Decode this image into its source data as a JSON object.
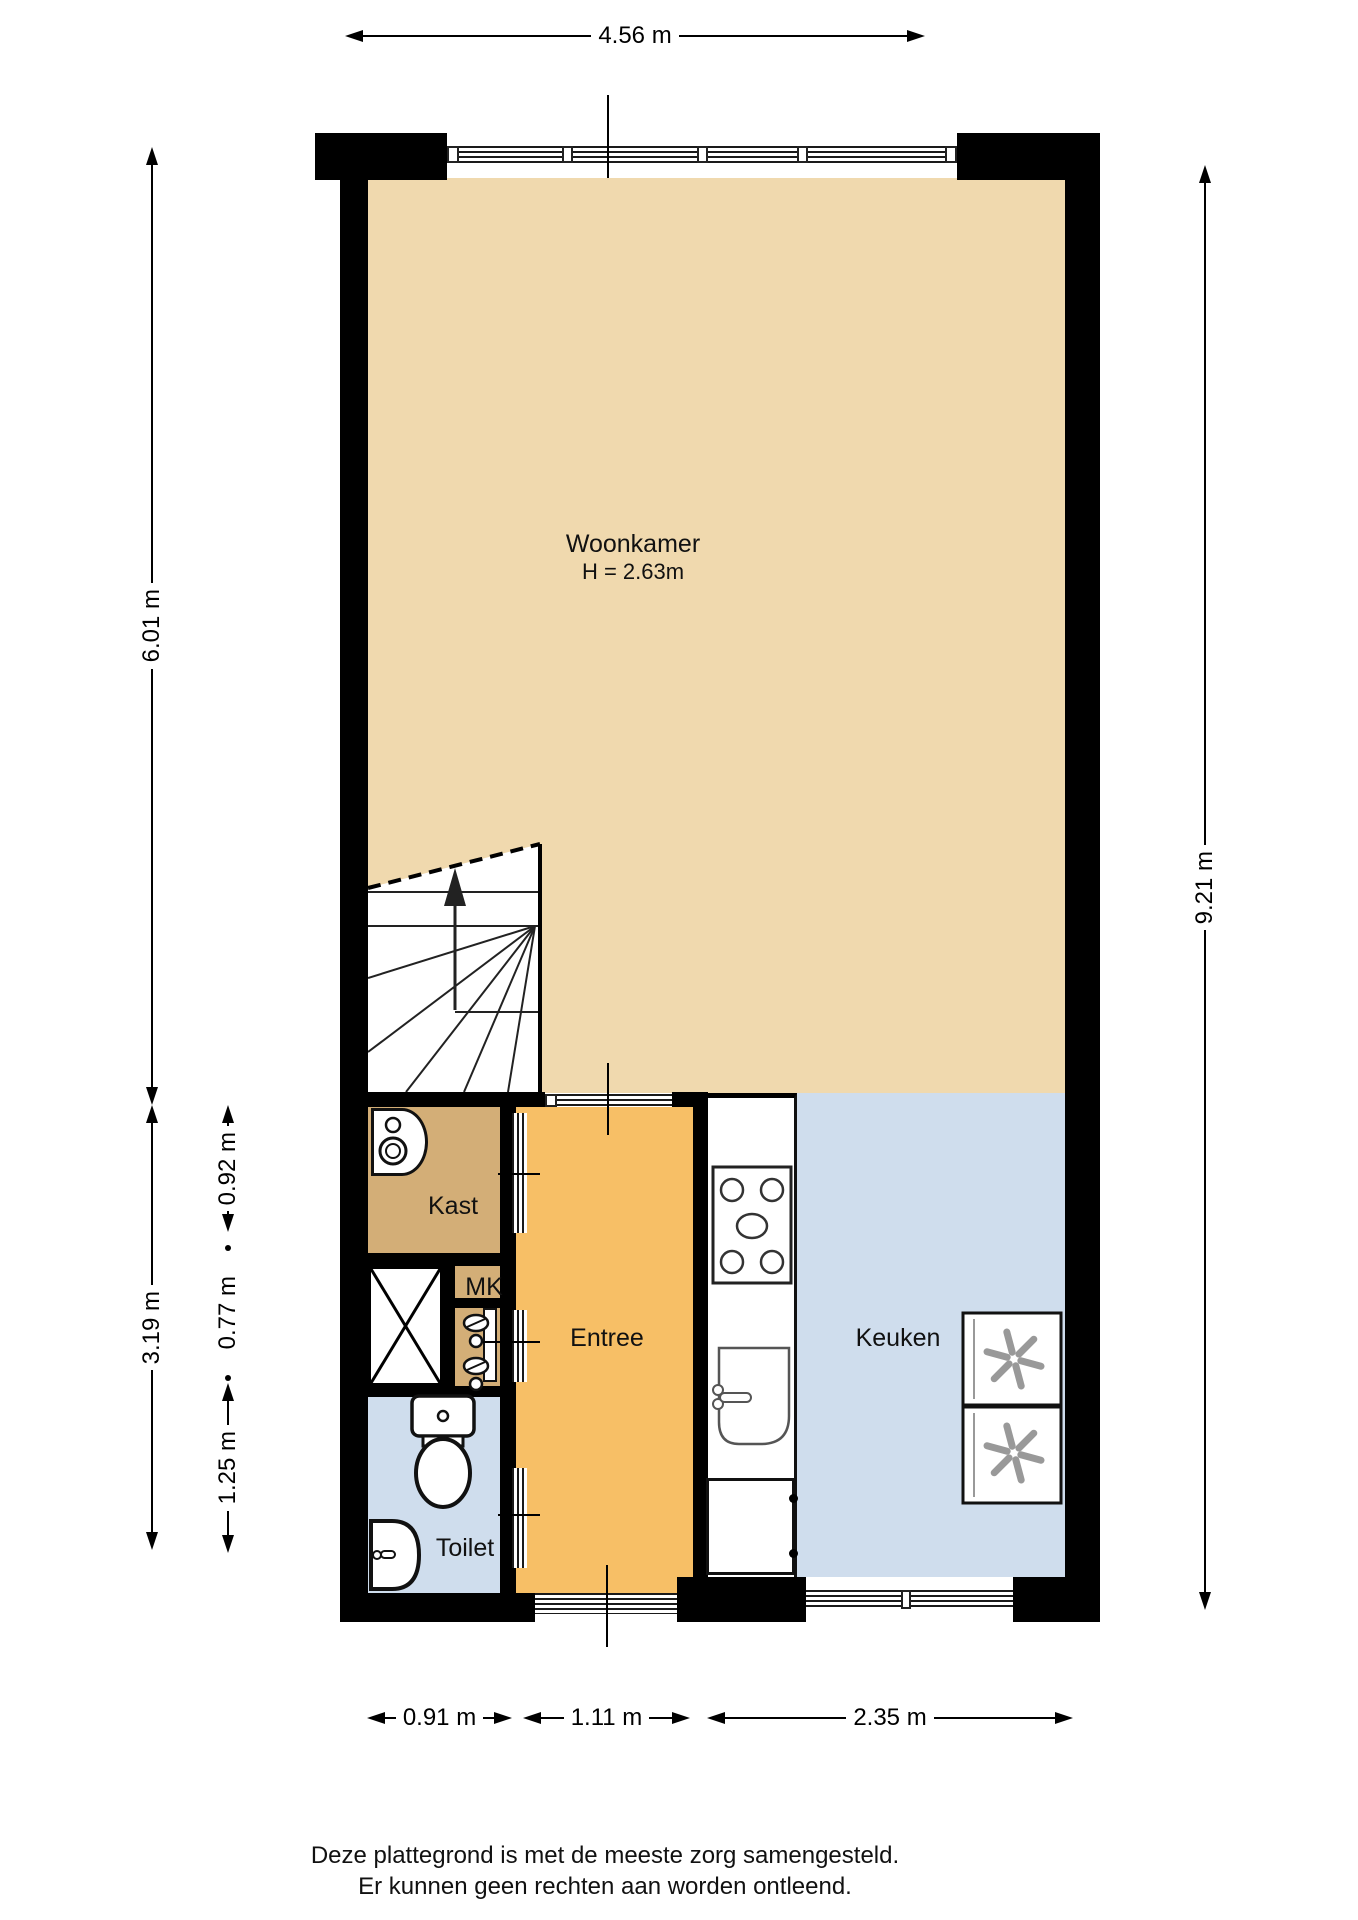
{
  "floorplan": {
    "rooms": {
      "woonkamer": {
        "label": "Woonkamer",
        "ceiling_height": "H = 2.63m"
      },
      "kast": {
        "label": "Kast"
      },
      "mk": {
        "label": "MK"
      },
      "entree": {
        "label": "Entree"
      },
      "toilet": {
        "label": "Toilet"
      },
      "keuken": {
        "label": "Keuken"
      }
    },
    "dimensions": {
      "top_width": "4.56 m",
      "left_upper": "6.01 m",
      "left_lower_total": "3.19 m",
      "left_kast": "0.92 m",
      "left_mk": "0.77 m",
      "left_toilet": "1.25 m",
      "right_height": "9.21 m",
      "bottom_toilet": "0.91 m",
      "bottom_entree": "1.11 m",
      "bottom_keuken": "2.35 m"
    },
    "colors": {
      "living_fill": "#f0d9ae",
      "closet_fill": "#d3ae77",
      "hall_fill": "#f7bf66",
      "wet_room_fill": "#cfdded",
      "wall": "#000000"
    },
    "icons": {
      "stairs": "stairs-up-arrow-icon",
      "washer": "washing-machine-icon",
      "meter": "electric-meter-icon",
      "shaft": "shaft-cross-icon",
      "toilet": "toilet-icon",
      "hand_basin": "hand-basin-icon",
      "stove": "stove-4-burner-icon",
      "sink": "kitchen-sink-icon",
      "fridge": "fridge-freezer-icon"
    },
    "footer": {
      "line1": "Deze plattegrond is met de meeste zorg samengesteld.",
      "line2": "Er kunnen geen rechten aan worden ontleend."
    }
  }
}
